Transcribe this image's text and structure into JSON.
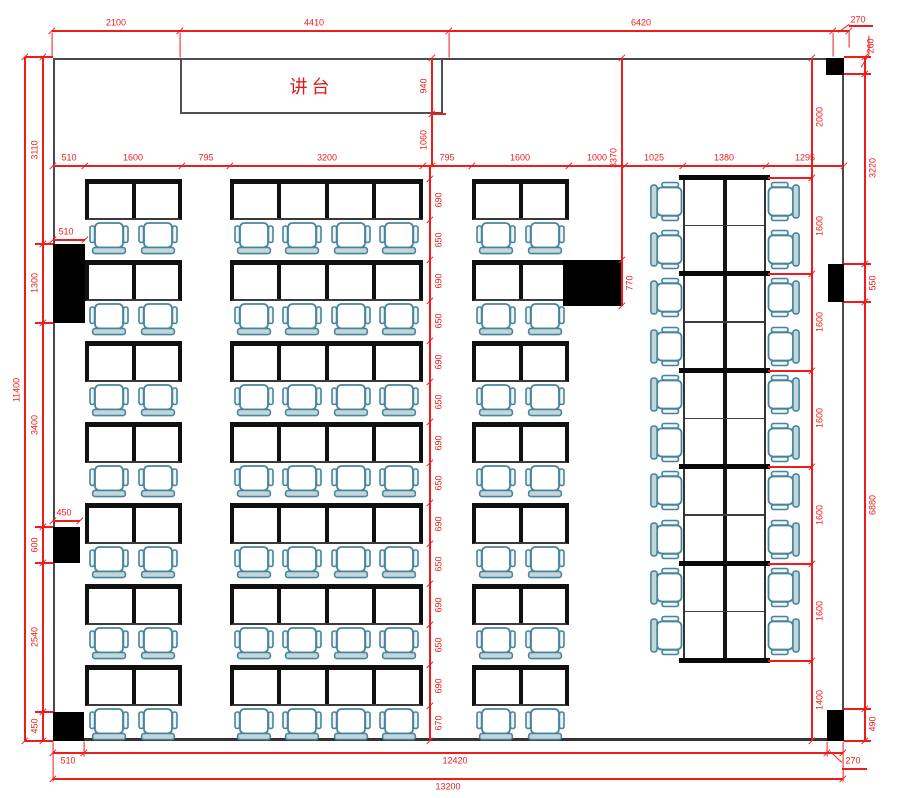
{
  "podium": {
    "label": "讲台"
  },
  "colors": {
    "dimension_red": "#ee1c1c",
    "wall_gray": "#4a4a4a",
    "desk_black": "#101010",
    "chair_stroke": "#47859b",
    "chair_back_fill": "#c3d6db",
    "pillar_black": "#000000"
  },
  "room": {
    "x": 53,
    "y": 58,
    "w": 791,
    "h": 683
  },
  "podium_box": {
    "x": 180,
    "y": 58,
    "w": 263,
    "h": 56
  },
  "pillars": [
    {
      "x": 826,
      "y": 58,
      "w": 18,
      "h": 17
    },
    {
      "x": 828,
      "y": 264,
      "w": 16,
      "h": 38
    },
    {
      "x": 827,
      "y": 710,
      "w": 17,
      "h": 31
    },
    {
      "x": 53,
      "y": 244,
      "w": 32,
      "h": 79
    },
    {
      "x": 53,
      "y": 527,
      "w": 27,
      "h": 36
    },
    {
      "x": 53,
      "y": 712,
      "w": 31,
      "h": 29
    },
    {
      "x": 563,
      "y": 260,
      "w": 59,
      "h": 46
    }
  ],
  "desk_area": {
    "row_tops": [
      179,
      260,
      341,
      422,
      503,
      584,
      665
    ],
    "desk_h": 41,
    "groups": [
      {
        "x": 85,
        "w": 97,
        "desks": 2
      },
      {
        "x": 230,
        "w": 193,
        "desks": 4
      },
      {
        "x": 472,
        "w": 97,
        "desks": 2
      }
    ]
  },
  "stack": {
    "x": 683,
    "w": 83,
    "top": 177,
    "rows": 10,
    "row_h": 48.3,
    "chair_left_cx": 666,
    "chair_right_cx": 784
  },
  "dims_h": [
    {
      "y": 31,
      "x1": 52,
      "x2": 849,
      "ticks": [
        52,
        180,
        449,
        833,
        849
      ],
      "dy": -8,
      "labels": [
        {
          "t": "2100",
          "x": 116
        },
        {
          "t": "4410",
          "x": 314
        },
        {
          "t": "6420",
          "x": 641
        }
      ]
    },
    {
      "y": 166,
      "x1": 53,
      "x2": 844,
      "ticks": [
        53,
        85,
        182,
        230,
        423,
        472,
        569,
        625,
        683,
        766,
        844
      ],
      "dy": -8,
      "labels": [
        {
          "t": "510",
          "x": 69
        },
        {
          "t": "1600",
          "x": 133
        },
        {
          "t": "795",
          "x": 206
        },
        {
          "t": "3200",
          "x": 327
        },
        {
          "t": "795",
          "x": 447
        },
        {
          "t": "1600",
          "x": 520
        },
        {
          "t": "1000",
          "x": 597
        },
        {
          "t": "1025",
          "x": 654
        },
        {
          "t": "1380",
          "x": 724
        },
        {
          "t": "1295",
          "x": 805
        }
      ]
    },
    {
      "y": 240,
      "x1": 53,
      "x2": 85,
      "ticks": [
        53,
        85
      ],
      "dy": -8,
      "labels": [
        {
          "t": "510",
          "x": 66
        }
      ]
    },
    {
      "y": 521,
      "x1": 53,
      "x2": 80,
      "ticks": [
        53,
        80
      ],
      "dy": -8,
      "labels": [
        {
          "t": "450",
          "x": 64
        }
      ]
    },
    {
      "y": 753,
      "x1": 53,
      "x2": 843,
      "ticks": [
        53,
        84,
        827,
        843
      ],
      "dy": 8,
      "labels": [
        {
          "t": "510",
          "x": 68
        },
        {
          "t": "12420",
          "x": 455
        }
      ]
    },
    {
      "y": 779,
      "x1": 53,
      "x2": 843,
      "ticks": [
        53,
        843
      ],
      "dy": 8,
      "labels": [
        {
          "t": "13200",
          "x": 448
        }
      ]
    }
  ],
  "dims_v": [
    {
      "x": 25,
      "y1": 57,
      "y2": 741,
      "ticks": [
        57,
        741
      ],
      "dx": -8,
      "labels": [
        {
          "t": "11400",
          "y": 390
        }
      ]
    },
    {
      "x": 43,
      "y1": 57,
      "y2": 741,
      "ticks": [
        57,
        244,
        323,
        527,
        563,
        712,
        741
      ],
      "dx": -8,
      "labels": [
        {
          "t": "3110",
          "y": 150
        },
        {
          "t": "1300",
          "y": 283
        },
        {
          "t": "3400",
          "y": 425
        },
        {
          "t": "600",
          "y": 545
        },
        {
          "t": "2540",
          "y": 637
        },
        {
          "t": "450",
          "y": 726
        }
      ]
    },
    {
      "x": 430,
      "y1": 166,
      "y2": 741,
      "ticks": [
        179,
        220,
        260,
        301,
        341,
        382,
        422,
        463,
        503,
        544,
        584,
        625,
        665,
        706,
        741
      ],
      "dx": 9,
      "labels": [
        {
          "t": "690",
          "y": 200
        },
        {
          "t": "650",
          "y": 240
        },
        {
          "t": "690",
          "y": 281
        },
        {
          "t": "650",
          "y": 321
        },
        {
          "t": "690",
          "y": 362
        },
        {
          "t": "650",
          "y": 402
        },
        {
          "t": "690",
          "y": 443
        },
        {
          "t": "650",
          "y": 483
        },
        {
          "t": "690",
          "y": 524
        },
        {
          "t": "650",
          "y": 564
        },
        {
          "t": "690",
          "y": 605
        },
        {
          "t": "650",
          "y": 645
        },
        {
          "t": "690",
          "y": 686
        },
        {
          "t": "670",
          "y": 723
        }
      ]
    },
    {
      "x": 432,
      "y1": 58,
      "y2": 166,
      "ticks": [
        58,
        114,
        166
      ],
      "dx": -8,
      "labels": [
        {
          "t": "940",
          "y": 86
        },
        {
          "t": "1060",
          "y": 140
        }
      ]
    },
    {
      "x": 622,
      "y1": 58,
      "y2": 306,
      "ticks": [
        58,
        260,
        306
      ],
      "dx": -8,
      "labels": [
        {
          "t": "3370",
          "y": 158
        },
        {
          "t": "770",
          "y": 283,
          "dx": 8
        }
      ]
    },
    {
      "x": 812,
      "y1": 58,
      "y2": 741,
      "ticks": [
        58,
        178,
        274,
        371,
        467,
        564,
        661,
        741
      ],
      "dx": 8,
      "labels": [
        {
          "t": "2000",
          "y": 117
        },
        {
          "t": "1600",
          "y": 226
        },
        {
          "t": "1600",
          "y": 322
        },
        {
          "t": "1600",
          "y": 418
        },
        {
          "t": "1600",
          "y": 515
        },
        {
          "t": "1600",
          "y": 611
        },
        {
          "t": "1400",
          "y": 700
        }
      ]
    },
    {
      "x": 865,
      "y1": 57,
      "y2": 741,
      "ticks": [
        57,
        74,
        264,
        302,
        709,
        741
      ],
      "dx": 8,
      "labels": [
        {
          "t": "3220",
          "y": 168
        },
        {
          "t": "550",
          "y": 283
        },
        {
          "t": "6880",
          "y": 505
        },
        {
          "t": "490",
          "y": 724
        }
      ]
    }
  ],
  "leader_labels": [
    {
      "t": "270",
      "x": 858,
      "y": 20,
      "rot": false
    },
    {
      "t": "260",
      "x": 871,
      "y": 46,
      "rot": true
    },
    {
      "t": "270",
      "x": 853,
      "y": 761,
      "rot": false
    }
  ],
  "ext_lines": [
    [
      52,
      33,
      52,
      57
    ],
    [
      180,
      33,
      180,
      58
    ],
    [
      449,
      33,
      449,
      58
    ],
    [
      833,
      33,
      833,
      57
    ],
    [
      849,
      31,
      849,
      48
    ],
    [
      838,
      33,
      849,
      25
    ],
    [
      849,
      26,
      873,
      26
    ],
    [
      861,
      68,
      869,
      55
    ],
    [
      869,
      55,
      869,
      36
    ],
    [
      830,
      752,
      842,
      763
    ],
    [
      842,
      769,
      867,
      769
    ],
    [
      25,
      57,
      53,
      57
    ],
    [
      25,
      741,
      53,
      741
    ],
    [
      35,
      244,
      53,
      244
    ],
    [
      35,
      323,
      53,
      323
    ],
    [
      35,
      527,
      53,
      527
    ],
    [
      35,
      563,
      53,
      563
    ],
    [
      35,
      712,
      53,
      712
    ],
    [
      844,
      57,
      871,
      57
    ],
    [
      844,
      74,
      871,
      74
    ],
    [
      844,
      264,
      871,
      264
    ],
    [
      844,
      302,
      871,
      302
    ],
    [
      844,
      709,
      871,
      709
    ],
    [
      844,
      741,
      871,
      741
    ],
    [
      768,
      178,
      812,
      178
    ],
    [
      768,
      274,
      812,
      274
    ],
    [
      768,
      371,
      812,
      371
    ],
    [
      768,
      467,
      812,
      467
    ],
    [
      768,
      564,
      812,
      564
    ],
    [
      768,
      661,
      812,
      661
    ],
    [
      53,
      742,
      53,
      782
    ],
    [
      843,
      742,
      843,
      782
    ],
    [
      84,
      742,
      84,
      757
    ],
    [
      827,
      742,
      827,
      757
    ],
    [
      432,
      114,
      446,
      114
    ]
  ]
}
